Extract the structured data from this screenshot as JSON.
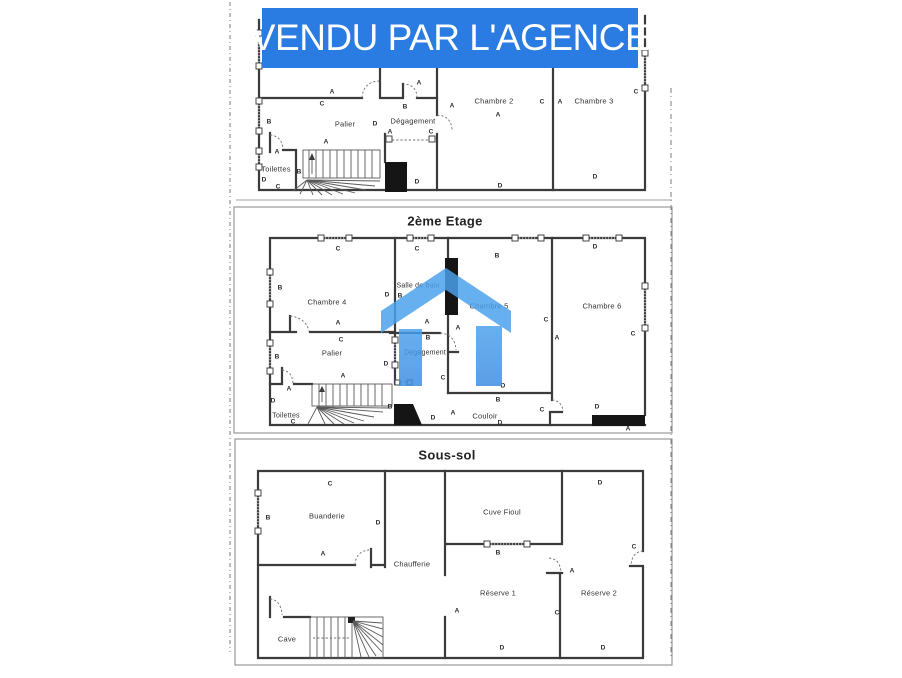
{
  "banner": {
    "label": "VENDU PAR L'AGENCE"
  },
  "colors": {
    "banner_blue": "#2b7ce2",
    "logo_blue": "#4ba1ec",
    "logo_blue_dark": "#3e8ce2",
    "plan_ink": "#3b3b3b"
  },
  "logo": {
    "name": "blue-house-logo"
  },
  "floors": [
    {
      "name": "etage-1",
      "title": "",
      "rooms": [
        {
          "label": "Palier"
        },
        {
          "label": "Dégagement"
        },
        {
          "label": "Chambre 2"
        },
        {
          "label": "Chambre 3"
        },
        {
          "label": "Toilettes"
        }
      ],
      "dims": [
        {
          "t": "A",
          "x": 332,
          "y": 92
        },
        {
          "t": "C",
          "x": 322,
          "y": 104
        },
        {
          "t": "B",
          "x": 405,
          "y": 107
        },
        {
          "t": "A",
          "x": 419,
          "y": 83
        },
        {
          "t": "A",
          "x": 452,
          "y": 106
        },
        {
          "t": "A",
          "x": 390,
          "y": 132
        },
        {
          "t": "C",
          "x": 431,
          "y": 132
        },
        {
          "t": "D",
          "x": 375,
          "y": 124
        },
        {
          "t": "B",
          "x": 269,
          "y": 122
        },
        {
          "t": "A",
          "x": 277,
          "y": 152
        },
        {
          "t": "D",
          "x": 264,
          "y": 180
        },
        {
          "t": "C",
          "x": 278,
          "y": 187
        },
        {
          "t": "B",
          "x": 299,
          "y": 172
        },
        {
          "t": "A",
          "x": 326,
          "y": 142
        },
        {
          "t": "D",
          "x": 417,
          "y": 182
        },
        {
          "t": "D",
          "x": 500,
          "y": 186
        },
        {
          "t": "D",
          "x": 595,
          "y": 177
        },
        {
          "t": "C",
          "x": 636,
          "y": 92
        },
        {
          "t": "C",
          "x": 542,
          "y": 102
        },
        {
          "t": "A",
          "x": 560,
          "y": 102
        },
        {
          "t": "A",
          "x": 498,
          "y": 115
        }
      ]
    },
    {
      "name": "etage-2",
      "title": "2ème Etage",
      "rooms": [
        {
          "label": "Chambre 4"
        },
        {
          "label": "Salle de bain"
        },
        {
          "label": "Chambre 5"
        },
        {
          "label": "Chambre 6"
        },
        {
          "label": "Palier"
        },
        {
          "label": "Dégagement"
        },
        {
          "label": "Toilettes"
        },
        {
          "label": "Couloir"
        }
      ],
      "dims": [
        {
          "t": "C",
          "x": 338,
          "y": 249
        },
        {
          "t": "C",
          "x": 417,
          "y": 249
        },
        {
          "t": "B",
          "x": 497,
          "y": 256
        },
        {
          "t": "D",
          "x": 595,
          "y": 247
        },
        {
          "t": "B",
          "x": 280,
          "y": 288
        },
        {
          "t": "D",
          "x": 387,
          "y": 295
        },
        {
          "t": "B",
          "x": 400,
          "y": 296
        },
        {
          "t": "C",
          "x": 546,
          "y": 320
        },
        {
          "t": "A",
          "x": 557,
          "y": 338
        },
        {
          "t": "C",
          "x": 633,
          "y": 334
        },
        {
          "t": "A",
          "x": 338,
          "y": 323
        },
        {
          "t": "C",
          "x": 341,
          "y": 340
        },
        {
          "t": "A",
          "x": 427,
          "y": 322
        },
        {
          "t": "B",
          "x": 428,
          "y": 338
        },
        {
          "t": "A",
          "x": 458,
          "y": 328
        },
        {
          "t": "B",
          "x": 277,
          "y": 357
        },
        {
          "t": "D",
          "x": 386,
          "y": 364
        },
        {
          "t": "C",
          "x": 443,
          "y": 378
        },
        {
          "t": "A",
          "x": 343,
          "y": 376
        },
        {
          "t": "A",
          "x": 289,
          "y": 389
        },
        {
          "t": "D",
          "x": 273,
          "y": 401
        },
        {
          "t": "C",
          "x": 293,
          "y": 422
        },
        {
          "t": "D",
          "x": 433,
          "y": 418
        },
        {
          "t": "A",
          "x": 453,
          "y": 413
        },
        {
          "t": "B",
          "x": 498,
          "y": 400
        },
        {
          "t": "D",
          "x": 500,
          "y": 423
        },
        {
          "t": "C",
          "x": 542,
          "y": 410
        },
        {
          "t": "D",
          "x": 597,
          "y": 407
        },
        {
          "t": "D",
          "x": 503,
          "y": 386
        },
        {
          "t": "A",
          "x": 628,
          "y": 429
        },
        {
          "t": "B",
          "x": 390,
          "y": 407
        }
      ]
    },
    {
      "name": "sous-sol",
      "title": "Sous-sol",
      "rooms": [
        {
          "label": "Buanderie"
        },
        {
          "label": "Cuve Fioul"
        },
        {
          "label": "Chaufferie"
        },
        {
          "label": "Réserve 1"
        },
        {
          "label": "Réserve 2"
        },
        {
          "label": "Cave"
        }
      ],
      "dims": [
        {
          "t": "C",
          "x": 330,
          "y": 484
        },
        {
          "t": "B",
          "x": 268,
          "y": 518
        },
        {
          "t": "D",
          "x": 378,
          "y": 523
        },
        {
          "t": "D",
          "x": 600,
          "y": 483
        },
        {
          "t": "B",
          "x": 498,
          "y": 553
        },
        {
          "t": "A",
          "x": 323,
          "y": 554
        },
        {
          "t": "C",
          "x": 634,
          "y": 547
        },
        {
          "t": "A",
          "x": 572,
          "y": 571
        },
        {
          "t": "A",
          "x": 457,
          "y": 611
        },
        {
          "t": "C",
          "x": 557,
          "y": 613
        },
        {
          "t": "D",
          "x": 502,
          "y": 648
        },
        {
          "t": "D",
          "x": 603,
          "y": 648
        }
      ]
    }
  ]
}
